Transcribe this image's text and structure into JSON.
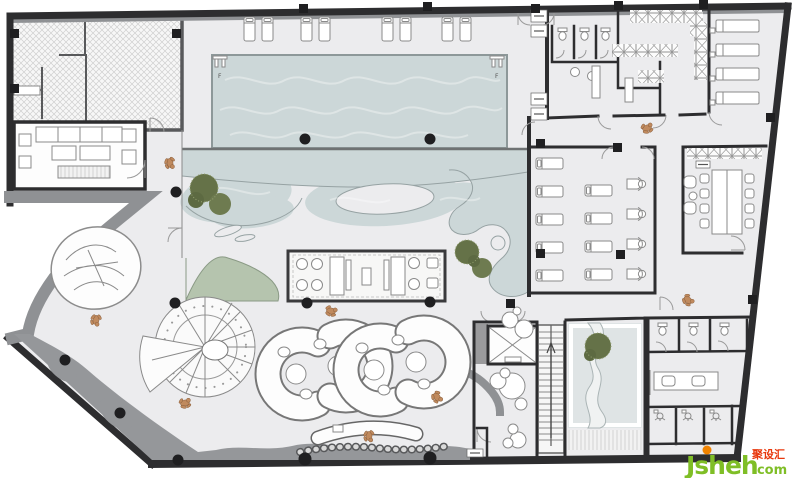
{
  "plan": {
    "type": "spa-bathhouse-floor-plan",
    "pool": {
      "ladder_label": "F",
      "ladder_count": 2,
      "poolside_loungers": 8
    },
    "rooms": [
      {
        "name": "back-of-house",
        "style": "hatched"
      },
      {
        "name": "vip-lounge",
        "sofas": 1,
        "armchairs": 4,
        "coffee_tables": 2
      },
      {
        "name": "swimming-pool"
      },
      {
        "name": "leisure-water-garden",
        "trees": 2,
        "planters": 1
      },
      {
        "name": "bar-island",
        "stools": 8,
        "counters": 2
      },
      {
        "name": "spiral-staircase"
      },
      {
        "name": "curved-seating-pods",
        "pods": 2,
        "round_tables": 4
      },
      {
        "name": "reception-desk"
      },
      {
        "name": "changing-room",
        "wc_stalls": 3,
        "sinks": 2,
        "locker_runs": 4
      },
      {
        "name": "massage-room",
        "beds": 4
      },
      {
        "name": "relaxation-lounge",
        "loungers": 9,
        "massage_chairs": 4
      },
      {
        "name": "tea-room",
        "table_seats": 8,
        "armchairs": 2
      },
      {
        "name": "zen-courtyard",
        "trees": 1
      },
      {
        "name": "elevator-core",
        "elevators": 1,
        "stairs": 1
      },
      {
        "name": "wc-shower-block",
        "wc_stalls": 3,
        "shower_stalls": 3,
        "vanity_sinks": 2
      }
    ],
    "figures": {
      "people": 8
    },
    "structure": {
      "round_columns": 11,
      "square_columns": 11
    }
  },
  "colors": {
    "wall": "#2d2d2f",
    "floor": "#ececee",
    "water": "#ccd7d8",
    "water_edge": "#96a2a3",
    "planter": "#b5c4ae",
    "tree": "#657248",
    "band": "#8f9194",
    "person": "#c08a5e",
    "hatch_bg": "#f7f7f7",
    "courtyard": "#dfe4e5"
  },
  "watermark": {
    "brand": "Jsheh",
    "tld": ".com",
    "cjk": "聚设汇",
    "brand_color": "#7fbe26",
    "cjk_color": "#e8380d",
    "dot_color": "#f08300"
  }
}
